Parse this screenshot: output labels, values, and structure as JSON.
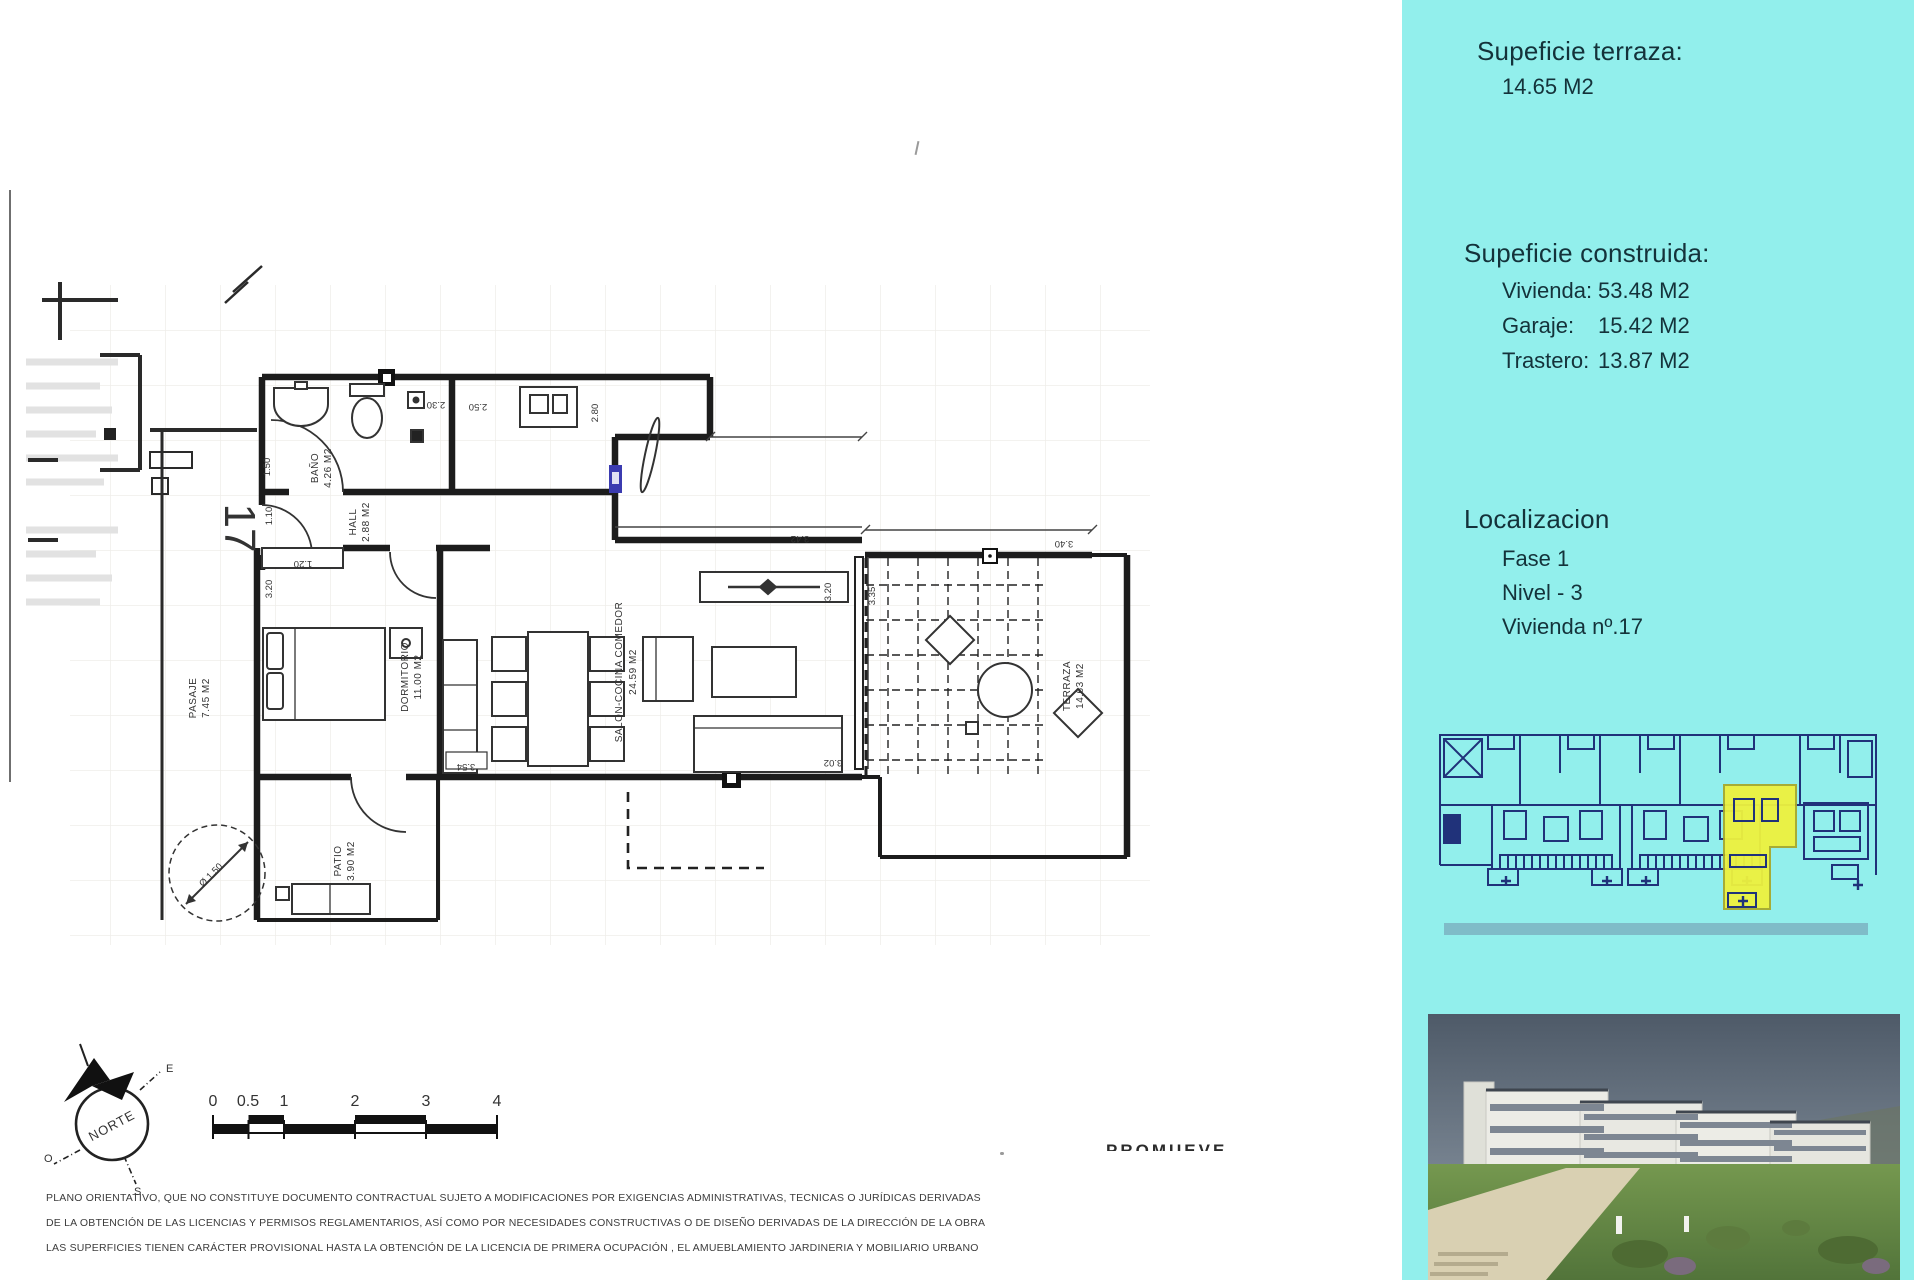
{
  "sidebar": {
    "bg": "#92efec",
    "terraza_title": "Supeficie terraza:",
    "terraza_value": "14.65 M2",
    "construida_title": "Supeficie construida:",
    "construida_rows": [
      {
        "label": "Vivienda:",
        "value": "53.48 M2"
      },
      {
        "label": "Garaje:",
        "value": "15.42 M2"
      },
      {
        "label": "Trastero:",
        "value": "13.87 M2"
      }
    ],
    "localizacion_title": "Localizacion",
    "localizacion_lines": [
      "Fase 1",
      "Nivel - 3",
      "Vivienda nº.17"
    ]
  },
  "plan": {
    "unit_number": "17",
    "rooms": {
      "bano": {
        "name": "BAÑO",
        "area": "4.26 M2"
      },
      "hall": {
        "name": "HALL",
        "area": "2.88 M2"
      },
      "dormitorio": {
        "name": "DORMITORIO",
        "area": "11.00 M2"
      },
      "salon": {
        "name": "SALON-COCINA COMEDOR",
        "area": "24.59 M2"
      },
      "terraza": {
        "name": "TERRAZA",
        "area": "14.63 M2"
      },
      "patio": {
        "name": "PATIO",
        "area": "3.90 M2"
      },
      "pasaje": {
        "name": "PASAJE",
        "area": "7.45 M2"
      }
    },
    "dims": {
      "d230": "2.30",
      "d250": "2.50",
      "d280": "2.80",
      "d150": "1.50",
      "d110": "1.10",
      "d120": "1.20",
      "d320a": "3.20",
      "d354": "3.54",
      "d302": "3.02",
      "d342": "3.42",
      "d320b": "3.20",
      "d335": "3.35",
      "d340": "3.40",
      "dcircle": "Ø 1.50"
    }
  },
  "compass": {
    "north": "NORTE",
    "e": "E",
    "o": "O",
    "s": "S"
  },
  "scalebar": {
    "labels": [
      "0",
      "0.5",
      "1",
      "2",
      "3",
      "4"
    ]
  },
  "promueve_label": "PROMUEVE",
  "disclaimer": {
    "lines": [
      "PLANO ORIENTATIVO, QUE NO CONSTITUYE DOCUMENTO CONTRACTUAL SUJETO A MODIFICACIONES POR EXIGENCIAS ADMINISTRATIVAS, TECNICAS O JURÍDICAS DERIVADAS",
      "DE LA OBTENCIÓN DE LAS LICENCIAS Y PERMISOS REGLAMENTARIOS, ASÍ COMO POR NECESIDADES CONSTRUCTIVAS  O DE DISEÑO DERIVADAS DE LA DIRECCIÓN DE LA OBRA",
      "LAS SUPERFICIES TIENEN CARÁCTER PROVISIONAL HASTA LA OBTENCIÓN DE LA LICENCIA DE PRIMERA OCUPACIÓN , EL AMUEBLAMIENTO JARDINERIA Y MOBILIARIO URBANO"
    ]
  },
  "colors": {
    "cyan": "#92efec",
    "highlight": "#eef23e",
    "siteplan_line": "#20327a"
  }
}
